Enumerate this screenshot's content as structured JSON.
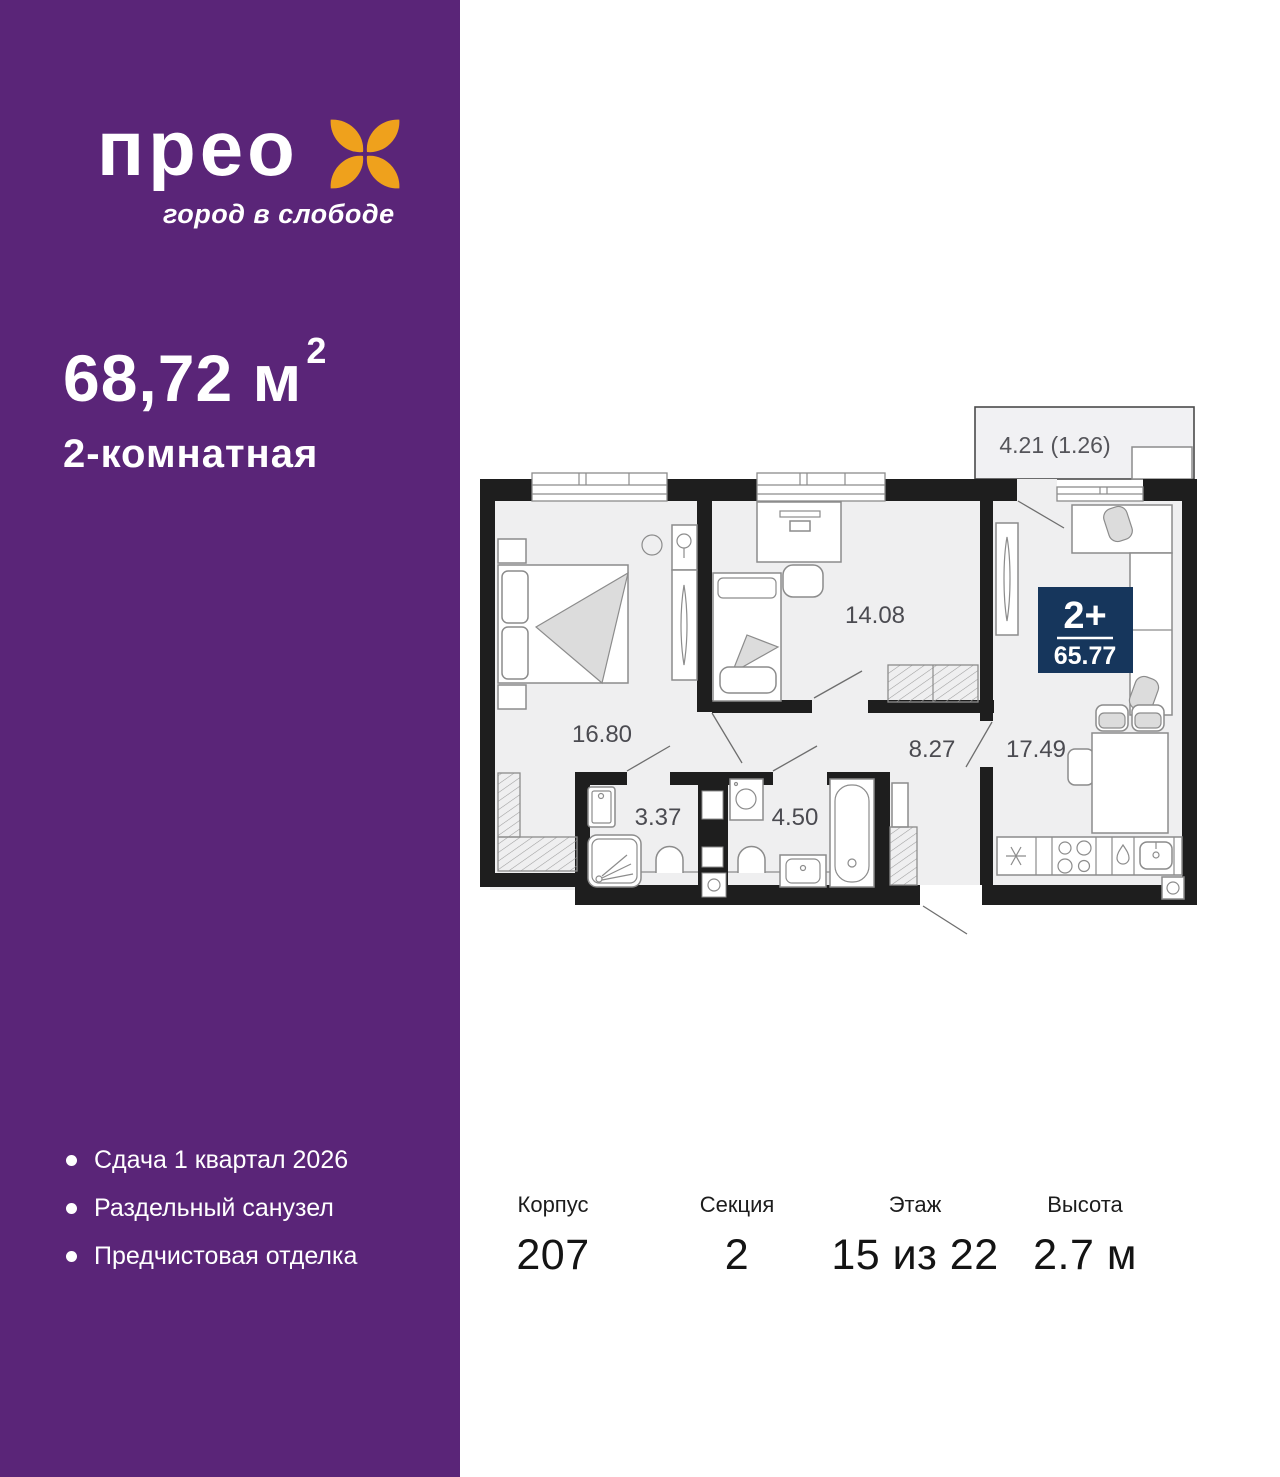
{
  "colors": {
    "sidebar_purple": "#5A2578",
    "logo_orange": "#EFA11C",
    "badge_navy": "#16365C",
    "wall_black": "#1E1E1E",
    "floor_gray": "#EFEFF0"
  },
  "brand": {
    "logo_text": "прео",
    "tagline": "город в слободе"
  },
  "listing": {
    "area_value": "68,72 м",
    "area_sup": "2",
    "rooms_type": "2-комнатная"
  },
  "features": [
    "Сдача 1 квартал 2026",
    "Раздельный санузел",
    "Предчистовая отделка"
  ],
  "floor_plan": {
    "badge": {
      "rooms": "2+",
      "total_area": "65.77"
    },
    "rooms": [
      {
        "name": "bedroom",
        "area": "16.80"
      },
      {
        "name": "room",
        "area": "14.08"
      },
      {
        "name": "hallway",
        "area": "8.27"
      },
      {
        "name": "kitchen-living-room",
        "area": "17.49"
      },
      {
        "name": "shower-room",
        "area": "3.37"
      },
      {
        "name": "bathroom",
        "area": "4.50"
      },
      {
        "name": "balcony",
        "area": "4.21 (1.26)"
      }
    ]
  },
  "details": [
    {
      "label": "Корпус",
      "value": "207"
    },
    {
      "label": "Секция",
      "value": "2"
    },
    {
      "label": "Этаж",
      "value": "15 из 22"
    },
    {
      "label": "Высота",
      "value": "2.7 м"
    }
  ]
}
